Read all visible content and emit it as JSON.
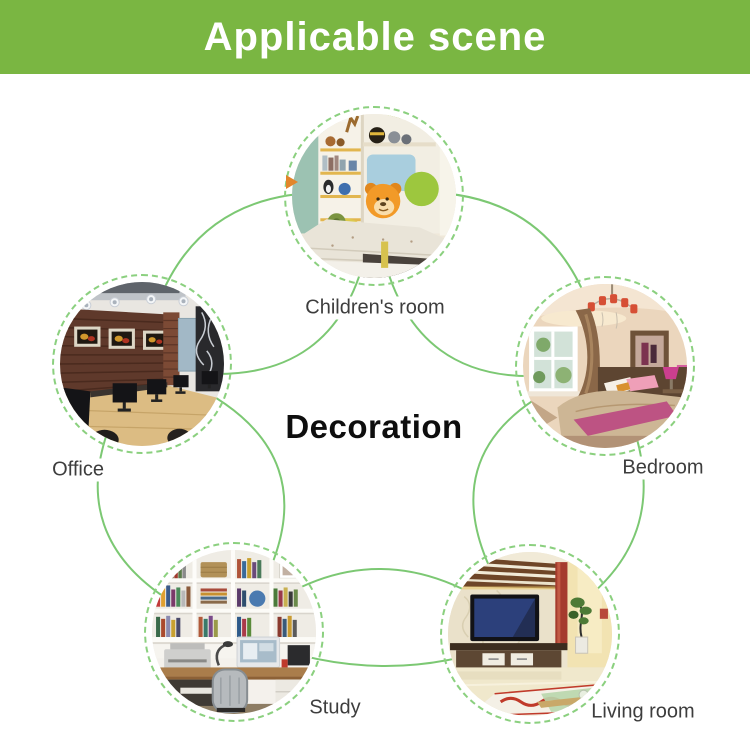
{
  "header": {
    "title": "Applicable scene",
    "bg_color": "#7ab642",
    "text_color": "#ffffff"
  },
  "diagram": {
    "center_title": "Decoration",
    "line_color": "#7cc873",
    "ring_color": "#8bd07f",
    "arrow_color": "#e2862b",
    "scenes": [
      {
        "id": "children-room",
        "label": "Children's room"
      },
      {
        "id": "bedroom",
        "label": "Bedroom"
      },
      {
        "id": "living-room",
        "label": "Living room"
      },
      {
        "id": "study",
        "label": "Study"
      },
      {
        "id": "office",
        "label": "Office"
      }
    ]
  }
}
